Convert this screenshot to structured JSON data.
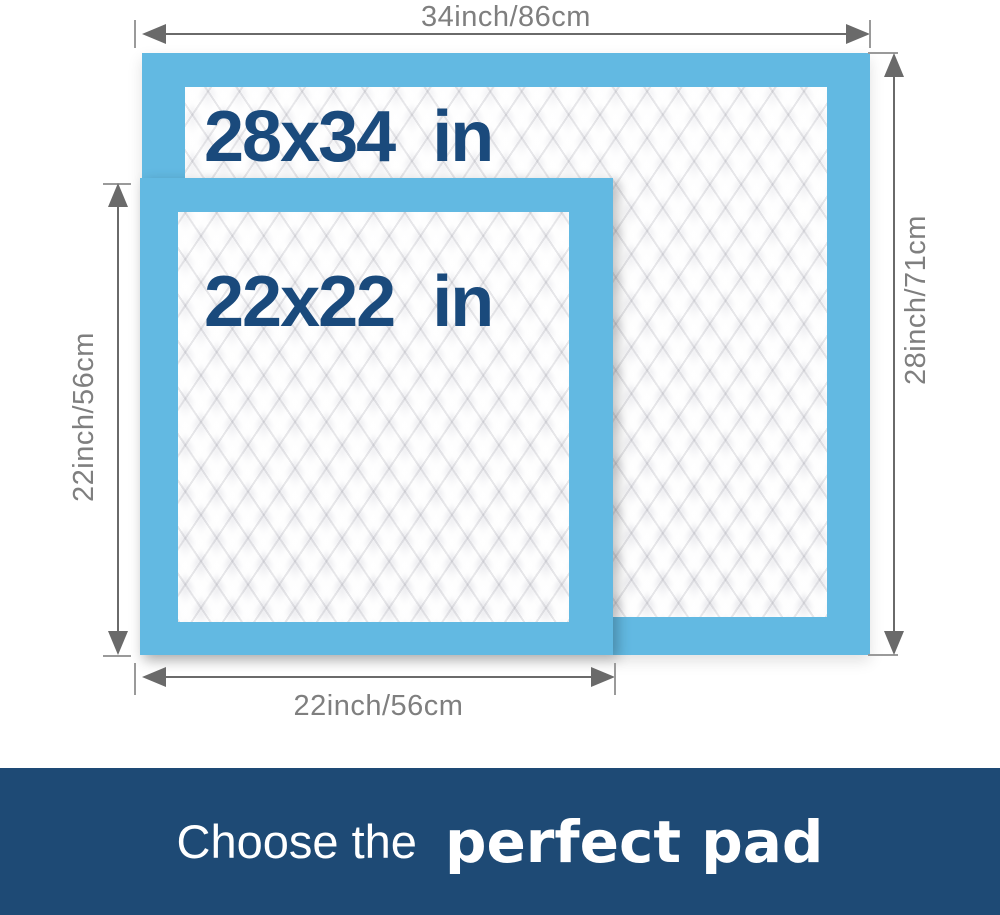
{
  "pads": {
    "large": {
      "label": "28x34 in"
    },
    "small": {
      "label": "22x22 in"
    }
  },
  "dimensions": {
    "top": "34inch/86cm",
    "right": "28inch/71cm",
    "left": "22inch/56cm",
    "bottom": "22inch/56cm"
  },
  "banner": {
    "prefix": "Choose the",
    "highlight": "perfect pad"
  },
  "colors": {
    "pad_border_blue": "#62b9e2",
    "pad_label_navy": "#1a4a7c",
    "dimension_gray": "#7f7f7f",
    "arrow_gray": "#6a6a6a",
    "banner_navy": "#1e4a75",
    "banner_text": "#ffffff"
  }
}
